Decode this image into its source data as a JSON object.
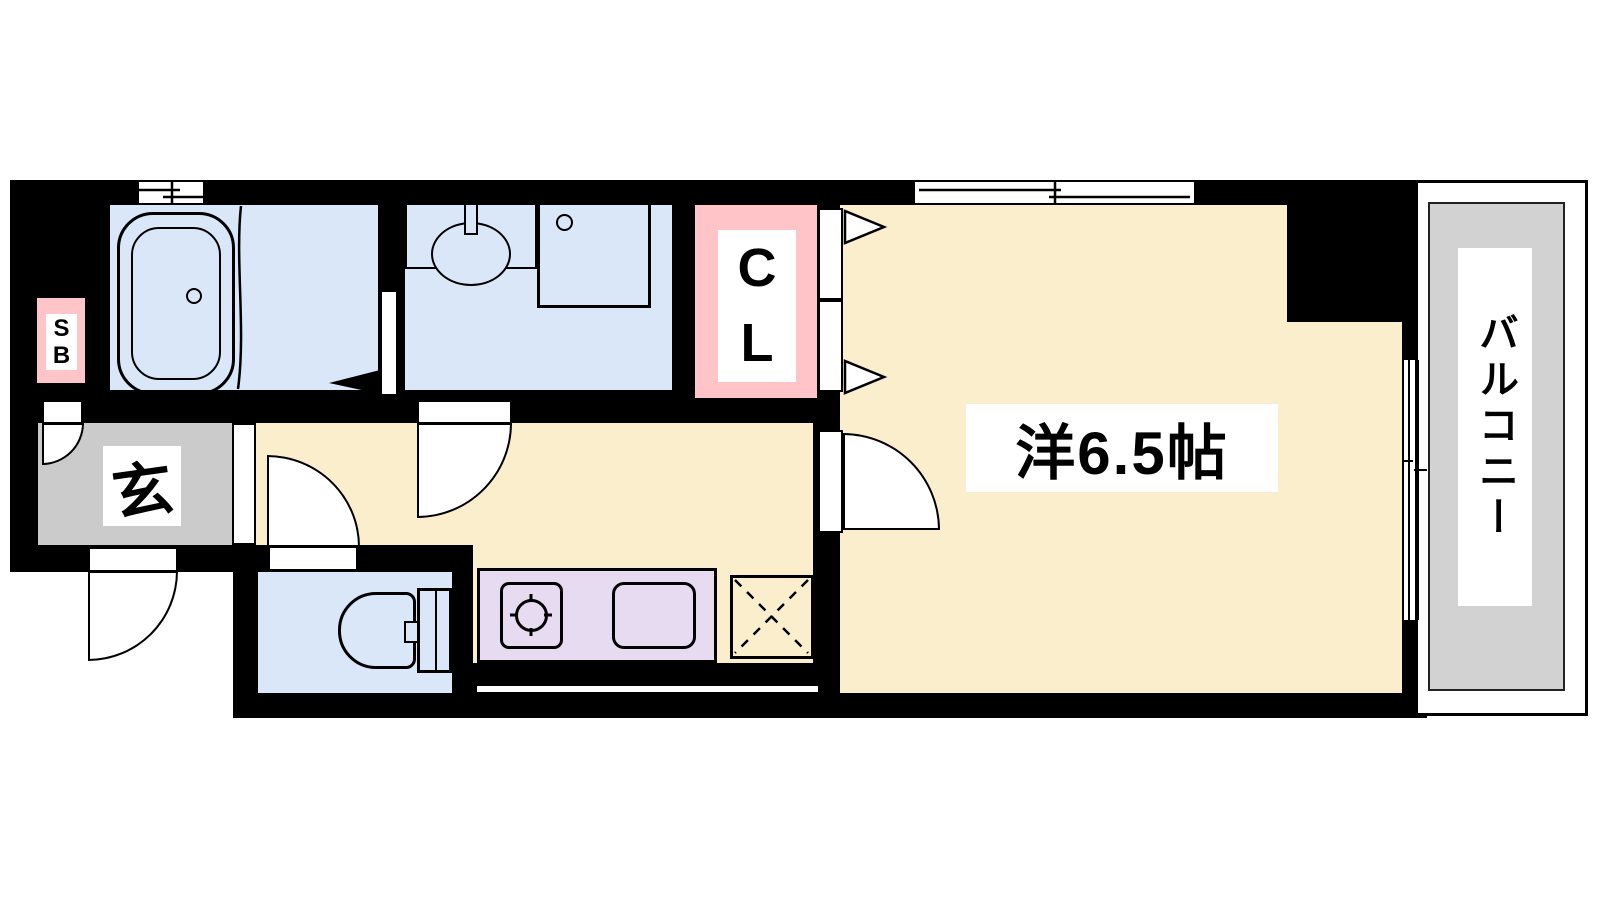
{
  "floorplan": {
    "type": "apartment-floor-plan-1K",
    "labels": {
      "entrance": "玄",
      "closet_line1": "C",
      "closet_line2": "L",
      "shoebox_line1": "S",
      "shoebox_line2": "B",
      "western_room": "洋6.5帖",
      "balcony": "バルコニー"
    },
    "colors": {
      "wall": "#000000",
      "wet_rooms": "#d9e7f8",
      "flooring": "#faeecd",
      "closet_fill": "#ffc4c8",
      "kitchen_counter": "#e7dbf1",
      "entrance_floor": "#cbcbcb",
      "balcony_floor": "#d2d2d2"
    },
    "fixtures": [
      "bathtub",
      "vanity-sink",
      "washing-machine-pan",
      "toilet",
      "gas-stove",
      "kitchen-sink",
      "refrigerator-space",
      "sliding-window",
      "balcony-sliding-door",
      "hinged-doors",
      "folding-closet-door"
    ]
  }
}
